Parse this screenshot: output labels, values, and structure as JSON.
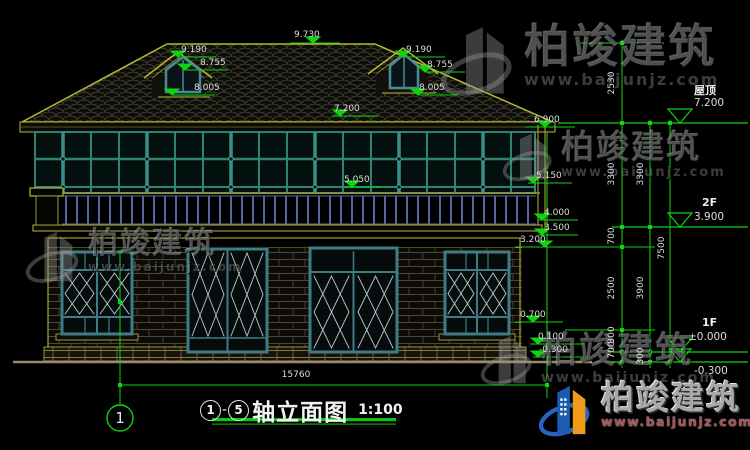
{
  "drawing": {
    "title": {
      "axis_start": "1",
      "separator": "-",
      "axis_end": "5",
      "name": "轴立面图",
      "scale": "1:100"
    },
    "axis_bubble_label": "1",
    "total_width_dim": "15760"
  },
  "levels_left": {
    "ridge": "9.730",
    "dormer_peak": "9.190",
    "dormer_eave": "8.755",
    "dormer_sill": "8.005",
    "eave_top": "7.200",
    "eave_bottom": "6.900",
    "beam_top": "5.150",
    "f2_sill": "5.050",
    "railing_base": "4.000",
    "f2_floor": "3.500",
    "window_head": "3.200",
    "window_sill": "0.700",
    "plinth_top": "0.100",
    "ground": "-0.300"
  },
  "levels_right": {
    "roof_label": "屋顶",
    "roof_value": "7.200",
    "f2_label": "2F",
    "f2_value": "3.900",
    "f1_label": "1F",
    "f1_value": "±0.000",
    "ground_value": "-0.300"
  },
  "chains": {
    "inner": [
      "2530",
      "3300",
      "700",
      "2500",
      "300",
      "700"
    ],
    "middle": [
      "3300",
      "3900",
      "300"
    ],
    "outer": [
      "7500"
    ]
  },
  "watermark": {
    "brand": "柏竣建筑",
    "site": "www.baijunjz.com"
  },
  "logo": {
    "brand": "柏竣建筑",
    "site": "www.baijunjz.com"
  },
  "colors": {
    "dimension_green": "#0fd40f",
    "cad_yellow": "#a8a832",
    "mullion_teal": "#2e8276",
    "railing_blue": "#5566a0"
  }
}
